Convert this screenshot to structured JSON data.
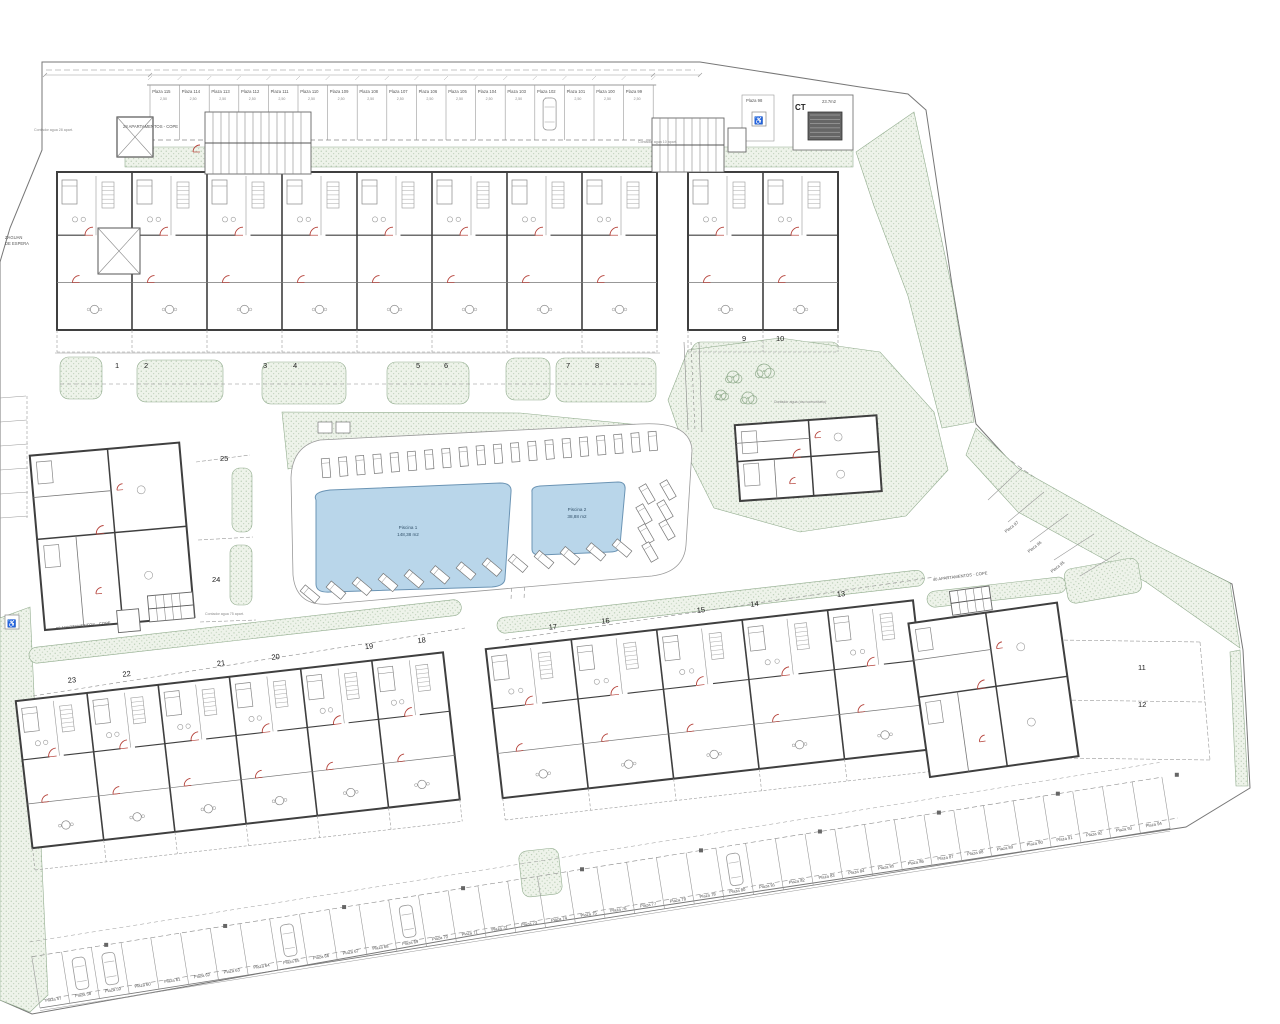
{
  "labels": {
    "ct": "CT",
    "ct_area": "23.7m2",
    "zaguan_line1": "ZAGUAN",
    "zaguan_line2": "DE ESPERA",
    "apartments_top": "28 APARTAMENTOS - COPE",
    "apartments_bottom_left": "28 APARTAMENTOS - COPE",
    "apartments_bottom_right": "40 APARTAMENTOS - COPE",
    "contador_28": "Contador agua 28 apart.",
    "contador_10": "Contador agua 10 apart.",
    "contador_75": "Contador agua 75 apart.",
    "contador_comunitario": "Contador agua (uso comunitario)"
  },
  "pools": [
    {
      "name": "Piscina 1",
      "area": "148,38 m2"
    },
    {
      "name": "Piscina 2",
      "area": "38,88 m2"
    }
  ],
  "units": {
    "top": [
      "1",
      "2",
      "3",
      "4",
      "5",
      "6",
      "7",
      "8"
    ],
    "top_right": [
      "9",
      "10"
    ],
    "mid_left": [
      "25",
      "24"
    ],
    "bottom_left": [
      "23",
      "22",
      "21",
      "20",
      "19",
      "18"
    ],
    "bottom_mid": [
      "17",
      "16",
      "15",
      "14",
      "13"
    ],
    "bottom_right": [
      "11",
      "12"
    ]
  },
  "parking": {
    "top": [
      "Plaza 115",
      "Plaza 114",
      "Plaza 113",
      "Plaza 112",
      "Plaza 111",
      "Plaza 110",
      "Plaza 109",
      "Plaza 108",
      "Plaza 107",
      "Plaza 106",
      "Plaza 105",
      "Plaza 104",
      "Plaza 103",
      "Plaza 102",
      "Plaza 101",
      "Plaza 100",
      "Plaza 99"
    ],
    "top_dim": "2,50",
    "isolated": "Plaza 98",
    "right": [
      "Plaza 97",
      "Plaza 96",
      "Plaza 95"
    ],
    "bottom": [
      "Plaza 57",
      "Plaza 58",
      "Plaza 59",
      "Plaza 60",
      "Plaza 61",
      "Plaza 62",
      "Plaza 63",
      "Plaza 64",
      "Plaza 65",
      "Plaza 66",
      "Plaza 67",
      "Plaza 68",
      "Plaza 69",
      "Plaza 70",
      "Plaza 71",
      "Plaza 72",
      "Plaza 73",
      "Plaza 74",
      "Plaza 75",
      "Plaza 76",
      "Plaza 77",
      "Plaza 78",
      "Plaza 79",
      "Plaza 80",
      "Plaza 81",
      "Plaza 82",
      "Plaza 83",
      "Plaza 84",
      "Plaza 85",
      "Plaza 86",
      "Plaza 87",
      "Plaza 88",
      "Plaza 89",
      "Plaza 90",
      "Plaza 91",
      "Plaza 92",
      "Plaza 93",
      "Plaza 94"
    ]
  },
  "icons": {
    "handicap": "♿"
  },
  "colors": {
    "green_fill": "#eef3ea",
    "green_dot": "#9fba9b",
    "green_line": "#93ad8f",
    "pool_fill": "#b9d6ea",
    "pool_edge": "#6b94b4",
    "wall": "#3f3f3f",
    "line": "#8a8a8a",
    "red": "#b5423a"
  }
}
